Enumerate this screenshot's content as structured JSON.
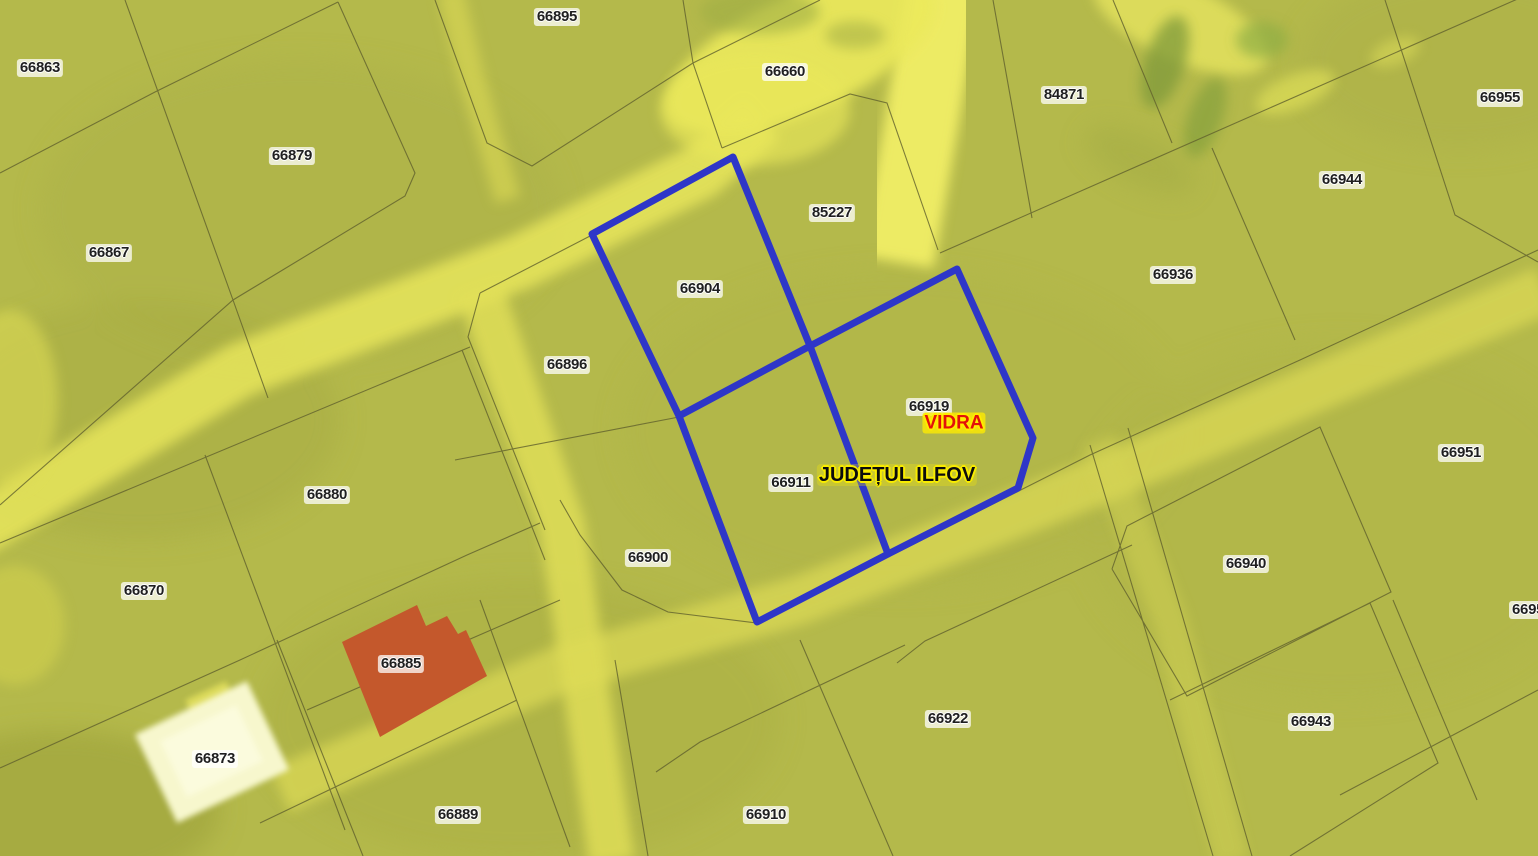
{
  "map": {
    "locality_label": "VIDRA",
    "county_label": "JUDEȚUL ILFOV",
    "selected_parcels": [
      "66904",
      "66911",
      "66919"
    ],
    "colors": {
      "selection_outline": "#2e36c8",
      "building_fill": "#c4582c",
      "white_building_fill": "#f7f7cd",
      "base_terrain": "#b4b94b",
      "road": "#e9e75c",
      "parcel_line": "#60602d",
      "label_text": "#1f1f1f",
      "locality_text": "#e31109"
    },
    "parcel_labels": [
      {
        "id": "66863",
        "x": 40,
        "y": 68
      },
      {
        "id": "66879",
        "x": 292,
        "y": 156
      },
      {
        "id": "66867",
        "x": 109,
        "y": 253
      },
      {
        "id": "66895",
        "x": 557,
        "y": 17
      },
      {
        "id": "66660",
        "x": 785,
        "y": 72
      },
      {
        "id": "84871",
        "x": 1064,
        "y": 95
      },
      {
        "id": "66955",
        "x": 1500,
        "y": 98
      },
      {
        "id": "66944",
        "x": 1342,
        "y": 180
      },
      {
        "id": "66936",
        "x": 1173,
        "y": 275
      },
      {
        "id": "85227",
        "x": 832,
        "y": 213
      },
      {
        "id": "66904",
        "x": 700,
        "y": 289
      },
      {
        "id": "66896",
        "x": 567,
        "y": 365
      },
      {
        "id": "66919",
        "x": 929,
        "y": 407
      },
      {
        "id": "66911",
        "x": 791,
        "y": 483
      },
      {
        "id": "66951",
        "x": 1461,
        "y": 453
      },
      {
        "id": "66880",
        "x": 327,
        "y": 495
      },
      {
        "id": "66870",
        "x": 144,
        "y": 591
      },
      {
        "id": "66900",
        "x": 648,
        "y": 558
      },
      {
        "id": "66940",
        "x": 1246,
        "y": 564
      },
      {
        "id": "66885",
        "x": 401,
        "y": 664
      },
      {
        "id": "66873",
        "x": 215,
        "y": 759
      },
      {
        "id": "66922",
        "x": 948,
        "y": 719
      },
      {
        "id": "66943",
        "x": 1311,
        "y": 722
      },
      {
        "id": "66889",
        "x": 458,
        "y": 815
      },
      {
        "id": "66910",
        "x": 766,
        "y": 815
      }
    ],
    "edge_label": {
      "id": "6695",
      "x": 1509,
      "y": 610
    }
  }
}
